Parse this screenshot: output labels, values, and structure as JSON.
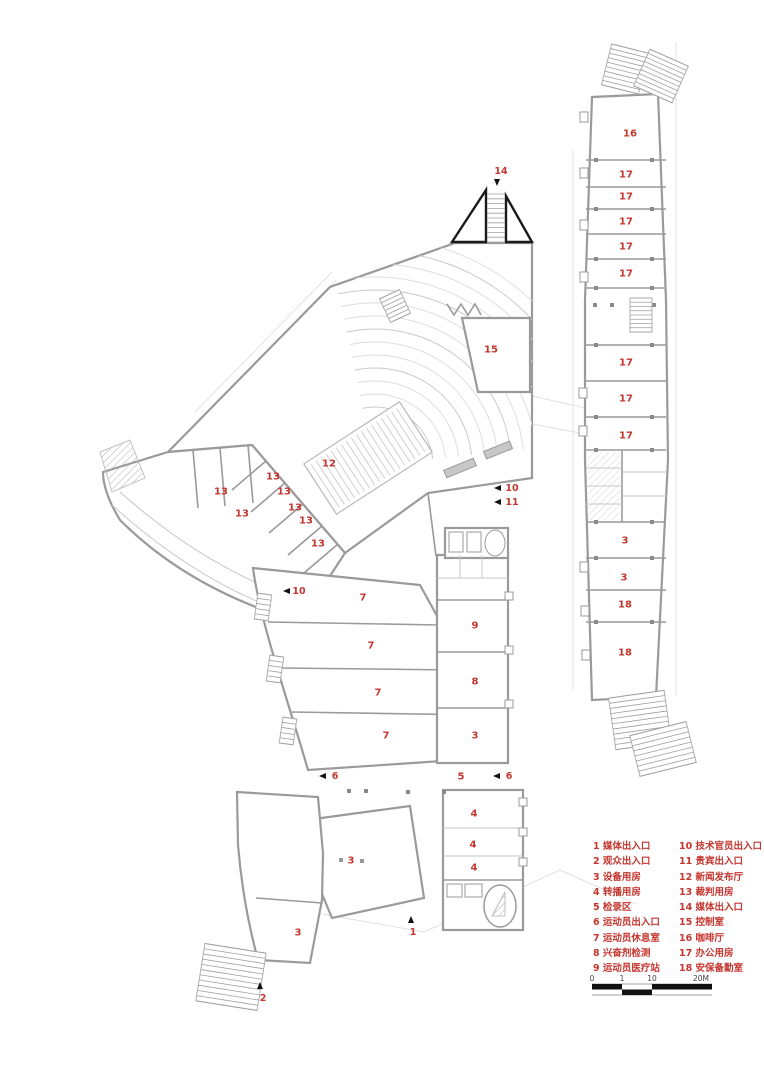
{
  "colors": {
    "label_red": "#c4362f",
    "wall_gray": "#9a9a9a",
    "stair_black": "#1a1a1a",
    "scale_black": "#111111"
  },
  "legend": {
    "columns": [
      {
        "items": [
          {
            "num": "1",
            "label": "媒体出入口"
          },
          {
            "num": "2",
            "label": "观众出入口"
          },
          {
            "num": "3",
            "label": "设备用房"
          },
          {
            "num": "4",
            "label": "转播用房"
          },
          {
            "num": "5",
            "label": "检录区"
          },
          {
            "num": "6",
            "label": "运动员出入口"
          },
          {
            "num": "7",
            "label": "运动员休息室"
          },
          {
            "num": "8",
            "label": "兴奋剂检测"
          },
          {
            "num": "9",
            "label": "运动员医疗站"
          }
        ]
      },
      {
        "items": [
          {
            "num": "10",
            "label": "技术官员出入口"
          },
          {
            "num": "11",
            "label": "贵宾出入口"
          },
          {
            "num": "12",
            "label": "新闻发布厅"
          },
          {
            "num": "13",
            "label": "裁判用房"
          },
          {
            "num": "14",
            "label": "媒体出入口"
          },
          {
            "num": "15",
            "label": "控制室"
          },
          {
            "num": "16",
            "label": "咖啡厅"
          },
          {
            "num": "17",
            "label": "办公用房"
          },
          {
            "num": "18",
            "label": "安保备勤室"
          }
        ]
      }
    ]
  },
  "scale_bar": {
    "ticks": [
      {
        "label": "0",
        "x": 592
      },
      {
        "label": "1",
        "x": 622
      },
      {
        "label": "10",
        "x": 652
      },
      {
        "label": "20M",
        "x": 701
      }
    ]
  },
  "plan": {
    "room_labels": [
      {
        "t": "16",
        "x": 630,
        "y": 133
      },
      {
        "t": "17",
        "x": 626,
        "y": 174
      },
      {
        "t": "17",
        "x": 626,
        "y": 196
      },
      {
        "t": "17",
        "x": 626,
        "y": 221
      },
      {
        "t": "17",
        "x": 626,
        "y": 246
      },
      {
        "t": "17",
        "x": 626,
        "y": 273
      },
      {
        "t": "17",
        "x": 626,
        "y": 362
      },
      {
        "t": "17",
        "x": 626,
        "y": 398
      },
      {
        "t": "17",
        "x": 626,
        "y": 435
      },
      {
        "t": "3",
        "x": 625,
        "y": 540
      },
      {
        "t": "3",
        "x": 624,
        "y": 577
      },
      {
        "t": "18",
        "x": 625,
        "y": 604
      },
      {
        "t": "18",
        "x": 625,
        "y": 652
      },
      {
        "t": "15",
        "x": 491,
        "y": 349
      },
      {
        "t": "12",
        "x": 329,
        "y": 463
      },
      {
        "t": "13",
        "x": 221,
        "y": 491
      },
      {
        "t": "13",
        "x": 242,
        "y": 513
      },
      {
        "t": "13",
        "x": 273,
        "y": 476
      },
      {
        "t": "13",
        "x": 284,
        "y": 491
      },
      {
        "t": "13",
        "x": 295,
        "y": 507
      },
      {
        "t": "13",
        "x": 306,
        "y": 520
      },
      {
        "t": "13",
        "x": 318,
        "y": 543
      },
      {
        "t": "7",
        "x": 363,
        "y": 597
      },
      {
        "t": "7",
        "x": 371,
        "y": 645
      },
      {
        "t": "7",
        "x": 378,
        "y": 692
      },
      {
        "t": "7",
        "x": 386,
        "y": 735
      },
      {
        "t": "9",
        "x": 475,
        "y": 625
      },
      {
        "t": "8",
        "x": 475,
        "y": 681
      },
      {
        "t": "3",
        "x": 475,
        "y": 735
      },
      {
        "t": "5",
        "x": 461,
        "y": 776
      },
      {
        "t": "4",
        "x": 474,
        "y": 813
      },
      {
        "t": "4",
        "x": 473,
        "y": 844
      },
      {
        "t": "4",
        "x": 474,
        "y": 867
      },
      {
        "t": "3",
        "x": 351,
        "y": 860
      },
      {
        "t": "3",
        "x": 298,
        "y": 932
      }
    ],
    "entrance_markers": [
      {
        "t": "14",
        "x": 501,
        "y": 171,
        "ax": 497,
        "ay": 181,
        "dir": "down"
      },
      {
        "t": "10",
        "x": 512,
        "y": 488,
        "ax": 498,
        "ay": 488,
        "dir": "left"
      },
      {
        "t": "11",
        "x": 512,
        "y": 502,
        "ax": 498,
        "ay": 502,
        "dir": "left"
      },
      {
        "t": "10",
        "x": 299,
        "y": 591,
        "ax": 287,
        "ay": 591,
        "dir": "left"
      },
      {
        "t": "6",
        "x": 335,
        "y": 776,
        "ax": 323,
        "ay": 776,
        "dir": "left"
      },
      {
        "t": "6",
        "x": 509,
        "y": 776,
        "ax": 497,
        "ay": 776,
        "dir": "left"
      },
      {
        "t": "1",
        "x": 413,
        "y": 932,
        "ax": 411,
        "ay": 921,
        "dir": "up"
      },
      {
        "t": "2",
        "x": 263,
        "y": 998,
        "ax": 260,
        "ay": 987,
        "dir": "up"
      }
    ]
  }
}
